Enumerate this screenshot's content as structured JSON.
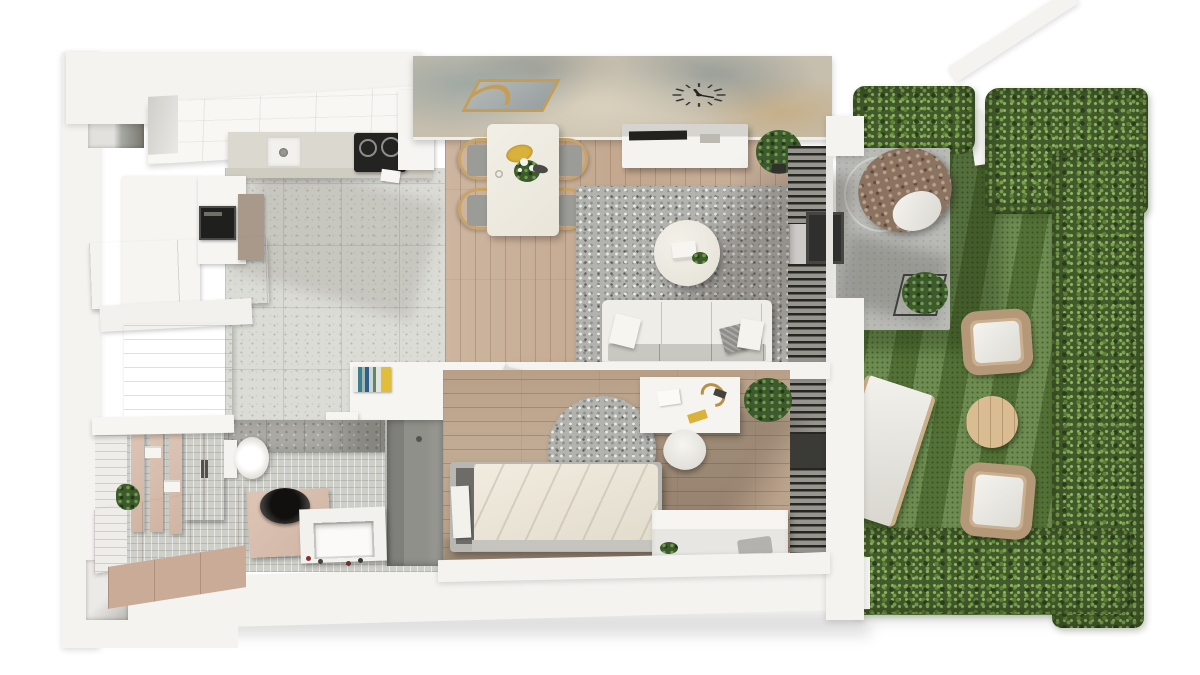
{
  "scene": {
    "label": "3D rendered top-down floor plan of a one-bedroom apartment with terrace and hedged garden",
    "background": "#ffffff"
  },
  "palette": {
    "wall_white": "#f4f3f0",
    "marble_wall": "#c7bfae",
    "kitchen_tile": "#dcdcd7",
    "living_wood": "#c9b09b",
    "bedroom_wood": "#bda68f",
    "rug_gray": "#b2b2af",
    "taupe_cabinet": "#ab9c8e",
    "bathroom_wood": "#d8bfb1",
    "grass": "#5e7f3d",
    "hedge": "#42592c",
    "patio_concrete": "#b9bab6",
    "rattan": "#b59878",
    "gold_accent": "#c69d55",
    "appliance_black": "#2b2b28"
  },
  "rooms": {
    "kitchen": {
      "label": "Kitchen",
      "furniture": [
        "tall white cabinets",
        "built-in oven",
        "taupe lower cabinets",
        "counter with sink",
        "black induction hob",
        "terrazzo tile floor"
      ]
    },
    "living_dining": {
      "label": "Living and dining room",
      "furniture": [
        "marble feature wall",
        "gold wall mirror",
        "wall clock",
        "dining table with flowers",
        "four wooden chairs",
        "white TV sideboard",
        "potted plant",
        "gray shag rug",
        "round white coffee table",
        "white three-seat sofa with pillows",
        "louvered glass wall"
      ]
    },
    "terrace": {
      "label": "Concrete terrace",
      "furniture": [
        "hanging egg chair",
        "wire cube planter"
      ]
    },
    "garden": {
      "label": "Hedged garden",
      "furniture": [
        "lawn with mowing stripes",
        "white sun lounger",
        "two wicker lounge chairs",
        "round wooden side table",
        "boxwood hedges",
        "white garden wall"
      ]
    },
    "hall": {
      "label": "Hall",
      "furniture": [
        "white storage unit with books",
        "floating shelf",
        "wall-mounted console"
      ]
    },
    "bathroom": {
      "label": "Bathroom",
      "furniture": [
        "white mosaic wall",
        "wood slat shelves with towels",
        "tall wood cabinet",
        "toilet",
        "dark round vessel sink on wood vanity",
        "washing machine",
        "walk-in shower",
        "long wood vanity",
        "small plant"
      ]
    },
    "bedroom": {
      "label": "Bedroom",
      "furniture": [
        "single bed with cream duvet",
        "round gray rug",
        "white desk with lamp",
        "white shell chair",
        "potted plant",
        "white storage bench",
        "white wardrobe",
        "radiator louvers"
      ]
    },
    "entry": {
      "label": "Entry",
      "furniture": [
        "wood panel wall",
        "entrance door recess",
        "white mosaic floor strip"
      ]
    }
  }
}
